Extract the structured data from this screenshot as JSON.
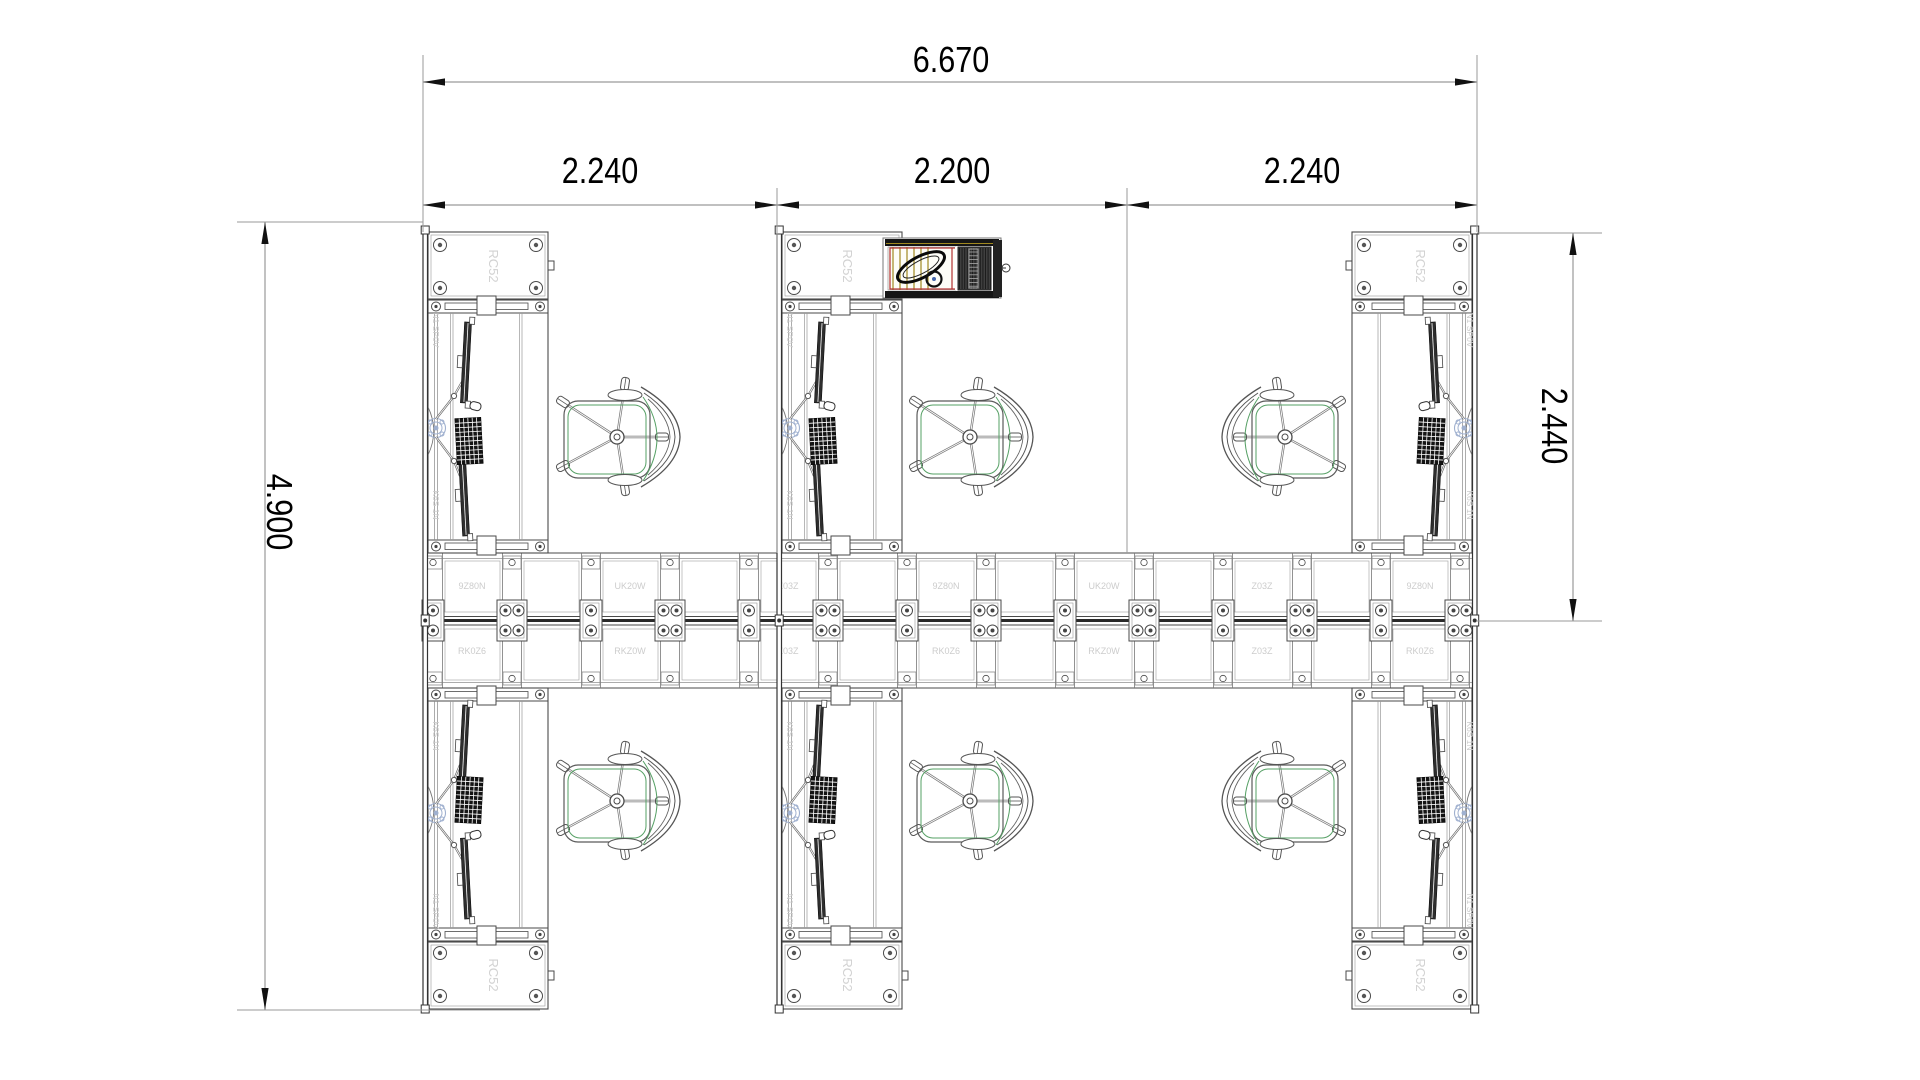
{
  "drawing": {
    "background": "#ffffff",
    "colors": {
      "line": "#4a4a4a",
      "line_light": "#8f8f8f",
      "dark": "#161616",
      "dim_line": "#9a9a9a",
      "dim_text": "#000000",
      "arrow": "#111111",
      "faint_label": "#cccccc",
      "chair_green": "#56a065",
      "clamp_blue": "#9fb0cf",
      "printer_yellow": "#a08820",
      "printer_red": "#b23030",
      "printer_dark": "#3f3f3f"
    },
    "dimensions": {
      "overall_width": "6.670",
      "segment_left": "2.240",
      "segment_middle": "2.200",
      "segment_right": "2.240",
      "total_depth": "4.900",
      "desk_zone_depth": "2.440"
    },
    "part_labels": {
      "return_unit": "RC52",
      "edge_upper": "N1 SP0V",
      "edge_lower": "K6S 1N",
      "spine_top_row": [
        "9Z80N",
        "UK20W",
        "Z03Z",
        "9Z80N",
        "UK20W",
        "Z03Z",
        "9Z80N"
      ],
      "spine_bottom_row": [
        "RK0Z6",
        "RKZ0W",
        "Z03Z",
        "RK0Z6",
        "RKZ0W",
        "Z03Z",
        "RK0Z6"
      ]
    },
    "layout": {
      "plan": {
        "left": 423,
        "right": 1477,
        "top": 232,
        "bottom": 1009,
        "mirror_sum": 1241
      },
      "rails": [
        423,
        777,
        1472.5
      ],
      "spine": {
        "x1": 427,
        "x2": 1473,
        "top": 553,
        "bottom": 688,
        "center": 620.5,
        "junction_start": 433,
        "junction_step": 79,
        "junction_count": 14,
        "label_xs": [
          472,
          630,
          788,
          946,
          1104,
          1262,
          1420
        ],
        "label_y_top": 589,
        "label_y_bottom": 654
      },
      "desk_width": 127,
      "desks": [
        {
          "x": 423,
          "row": "top",
          "mirror": false
        },
        {
          "x": 777,
          "row": "top",
          "mirror": false
        },
        {
          "x": 1350,
          "row": "top",
          "mirror": true
        },
        {
          "x": 423,
          "row": "bottom",
          "mirror": false
        },
        {
          "x": 777,
          "row": "bottom",
          "mirror": false
        },
        {
          "x": 1350,
          "row": "bottom",
          "mirror": true
        }
      ],
      "side_label_x": [
        433,
        787,
        1467
      ],
      "chairs": [
        {
          "cx": 617,
          "cy": 437,
          "mirror": false
        },
        {
          "cx": 970,
          "cy": 437,
          "mirror": false
        },
        {
          "cx": 1285,
          "cy": 437,
          "mirror": true
        },
        {
          "cx": 617,
          "cy": 801,
          "mirror": false
        },
        {
          "cx": 970,
          "cy": 801,
          "mirror": false
        },
        {
          "cx": 1285,
          "cy": 801,
          "mirror": true
        }
      ],
      "printer": {
        "x": 883,
        "y": 237
      },
      "dims": {
        "top": {
          "y": 82,
          "x1": 423,
          "x2": 1477,
          "ext_top": 55,
          "text_cx": 951,
          "text_cy": 60
        },
        "segments": {
          "y": 205,
          "bounds": [
            423,
            777,
            1127,
            1477
          ],
          "ext_top": 188,
          "text_cy": 171,
          "text_cxs": [
            600,
            952,
            1302
          ]
        },
        "left": {
          "x": 265,
          "y1": 222,
          "y2": 1010,
          "ext_x1": 237,
          "ext_top_x2": 423,
          "ext_bot_x2": 540,
          "text_cx": 279,
          "text_cy": 512
        },
        "right": {
          "x": 1573,
          "y1": 233,
          "y2": 621,
          "ext_x2": 1602,
          "text_cx": 1554,
          "text_cy": 426
        }
      }
    }
  }
}
